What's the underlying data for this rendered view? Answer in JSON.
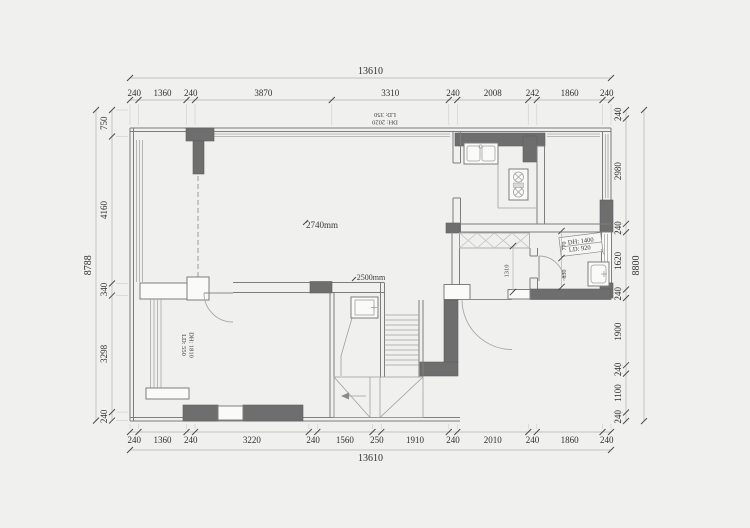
{
  "colors": {
    "background": "#f0f0ef",
    "wall_fill_dark": "#6e6e6e",
    "wall_line": "#7d7d7d",
    "dimension_text": "#2f2f2f"
  },
  "dimensions": {
    "top": {
      "overall": "13610",
      "segments": [
        "240",
        "1360",
        "240",
        "3870",
        "3310",
        "240",
        "2008",
        "242",
        "1860",
        "240"
      ]
    },
    "bottom": {
      "overall": "13610",
      "segments": [
        "240",
        "1360",
        "240",
        "3220",
        "240",
        "1560",
        "250",
        "1910",
        "240",
        "2010",
        "240",
        "1860",
        "240"
      ]
    },
    "left": {
      "overall": "8788",
      "segments": [
        "750",
        "4160",
        "340",
        "3298",
        "240"
      ]
    },
    "right": {
      "overall": "8800",
      "segments": [
        "240",
        "2980",
        "240",
        "1620",
        "240",
        "1900",
        "240",
        "1100",
        "240"
      ]
    }
  },
  "annotations": {
    "top_window_height": "DH: 2020",
    "top_window_sill": "LD: 350",
    "left_window_height": "DH: 1810",
    "left_window_sill": "LD: 550",
    "right_window_height": "DH: 1400",
    "right_window_sill": "LD: 920",
    "ceiling_main": "2740mm",
    "ceiling_stair": "2500mm",
    "hall_width": "1310",
    "bath_seg_a": "770",
    "bath_seg_b": "830"
  },
  "fixtures": [
    "kitchen-sink",
    "gas-stove",
    "washing-machine",
    "staircase",
    "bay-window",
    "closet",
    "entry-door",
    "bedroom-door",
    "bathroom-door"
  ]
}
